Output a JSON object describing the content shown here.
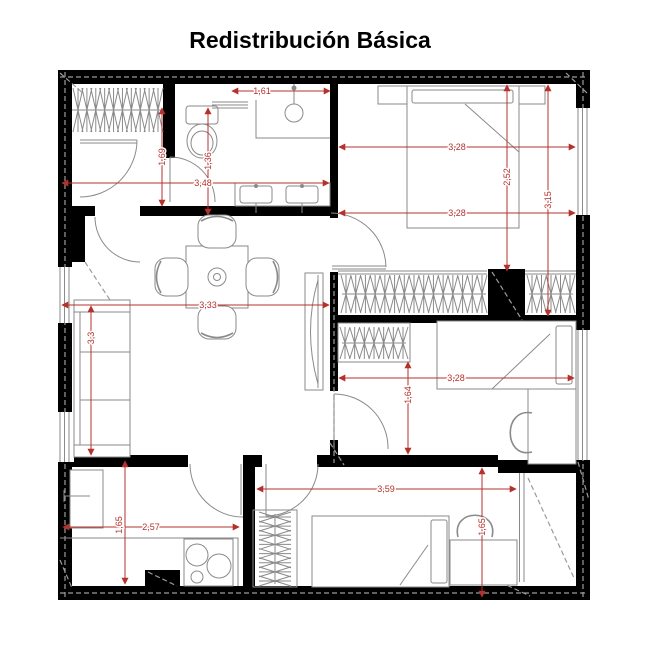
{
  "title": "Redistribución Básica",
  "colors": {
    "background": "#ffffff",
    "wall": "#000000",
    "furniture": "#8a8a8a",
    "dimension": "#b5312c"
  },
  "dimensions": [
    {
      "label": "1,61"
    },
    {
      "label": "1,69"
    },
    {
      "label": "1,36"
    },
    {
      "label": "3,48"
    },
    {
      "label": "3,28"
    },
    {
      "label": "2,52"
    },
    {
      "label": "3,15"
    },
    {
      "label": "3,28"
    },
    {
      "label": "3,33"
    },
    {
      "label": "3,3"
    },
    {
      "label": "3,28"
    },
    {
      "label": "1,64"
    },
    {
      "label": "3,59"
    },
    {
      "label": "1,65"
    },
    {
      "label": "2,57"
    },
    {
      "label": "1,65"
    }
  ]
}
